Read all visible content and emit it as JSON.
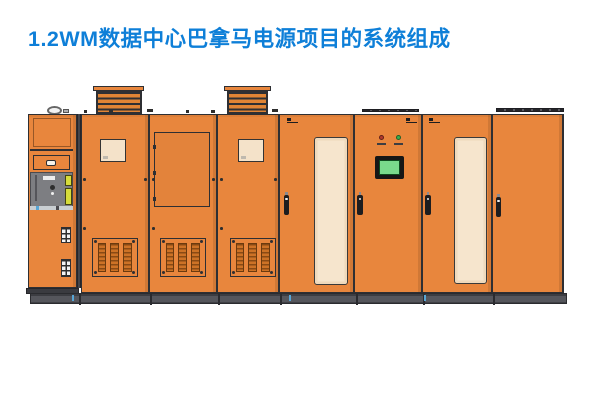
{
  "header": {
    "title": "1.2WM数据中心巴拿马电源项目的系统组成"
  },
  "theme": {
    "accent": "#0E7FD8",
    "cabinet": "#E8863D",
    "outline": "#2E2F33",
    "panel_beige": "#F4E2C9",
    "strip_beige": "#F6E5CD",
    "vent_fill": "#CD7226",
    "vent_line": "#8A4A14",
    "plinth": "#4E4F55",
    "screen_green": "#79DA8C",
    "indicator_red": "#B23A2C",
    "indicator_green": "#3BAE4C",
    "compartment_gray": "#7D7E82",
    "breaker_yellow": "#D6DC3A",
    "background": "#FFFFFF"
  },
  "diagram": {
    "description": "Front elevation of the Panama power project cabinet lineup: eight orange cabinets on a common dark plinth with two louvered roof ventilation hoods",
    "cabinets": [
      {
        "id": "cabinet-1",
        "role": "incoming-switch-cabinet"
      },
      {
        "id": "cabinet-2",
        "role": "vented-cabinet-with-window"
      },
      {
        "id": "cabinet-3",
        "role": "access-panel-cabinet"
      },
      {
        "id": "cabinet-4",
        "role": "vented-cabinet-with-window"
      },
      {
        "id": "cabinet-5",
        "role": "tall-panel-door-cabinet"
      },
      {
        "id": "cabinet-6",
        "role": "control-hmi-cabinet"
      },
      {
        "id": "cabinet-7",
        "role": "tall-panel-door-cabinet"
      },
      {
        "id": "cabinet-8",
        "role": "plain-door-cabinet"
      }
    ]
  }
}
